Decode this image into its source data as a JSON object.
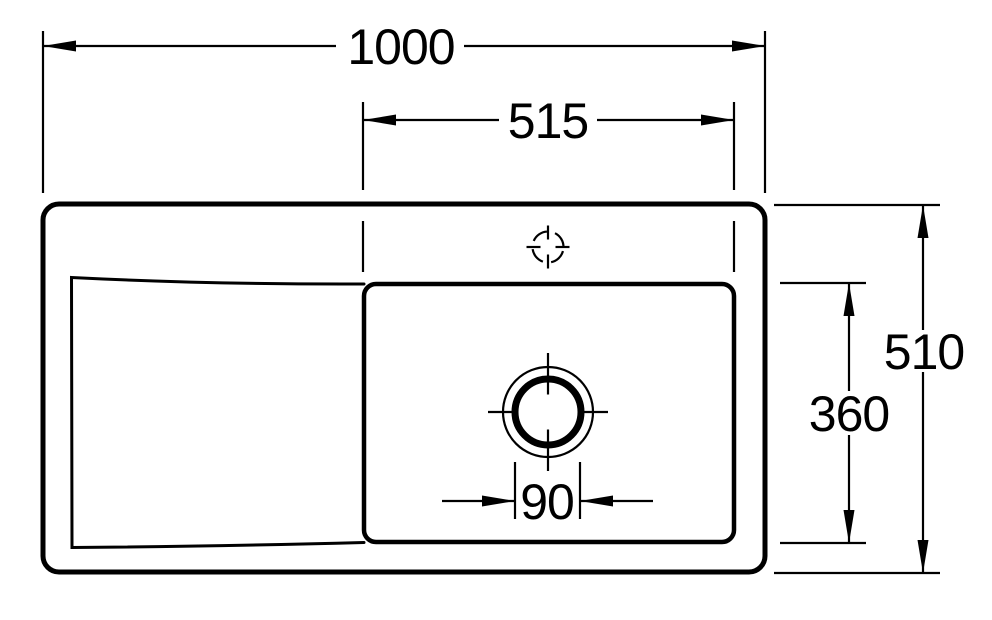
{
  "drawing": {
    "kind": "technical-dimension-drawing",
    "subject": "kitchen-sink-plan-view",
    "colors": {
      "line": "#000000",
      "background": "#ffffff"
    },
    "dimensions": {
      "overall_width": {
        "value": "1000"
      },
      "basin_width": {
        "value": "515"
      },
      "overall_depth": {
        "value": "510"
      },
      "basin_depth": {
        "value": "360"
      },
      "drain_diameter": {
        "value": "90"
      }
    }
  }
}
